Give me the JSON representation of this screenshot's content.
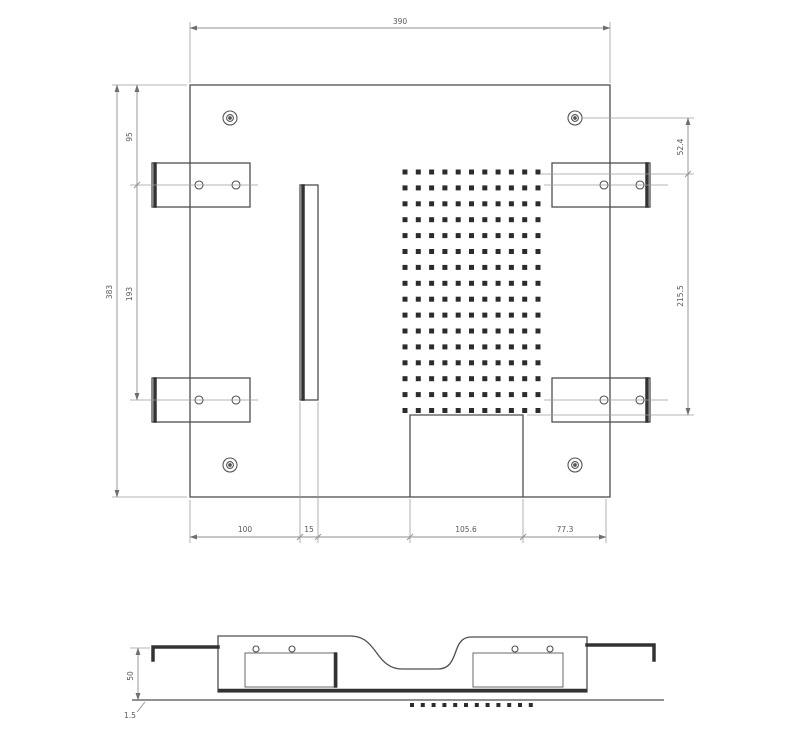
{
  "drawing": {
    "top_view": {
      "dims": {
        "overall_width": "390",
        "overall_height": "383",
        "left_upper": "95",
        "left_mid": "193",
        "right_upper": "52.4",
        "right_mid": "215.5",
        "bottom_seg1": "100",
        "bottom_seg2": "15",
        "bottom_seg3": "105.6",
        "bottom_seg4": "77.3"
      },
      "vent_grid": {
        "cols": 11,
        "rows": 16,
        "x": 405,
        "y": 172,
        "dx": 13.3,
        "dy": 15.9,
        "size": 5
      }
    },
    "side_view": {
      "dims": {
        "height": "50",
        "thickness": "1.5"
      },
      "hole_row": {
        "count": 12,
        "x": 412,
        "y": 703,
        "dx": 10.8,
        "size": 4
      }
    },
    "colors": {
      "object_line": "#4f4f4f",
      "thick_line": "#333333",
      "dim_line": "#8f8f8f",
      "hole_fill": "#2c2c2c",
      "background": "#ffffff"
    }
  }
}
